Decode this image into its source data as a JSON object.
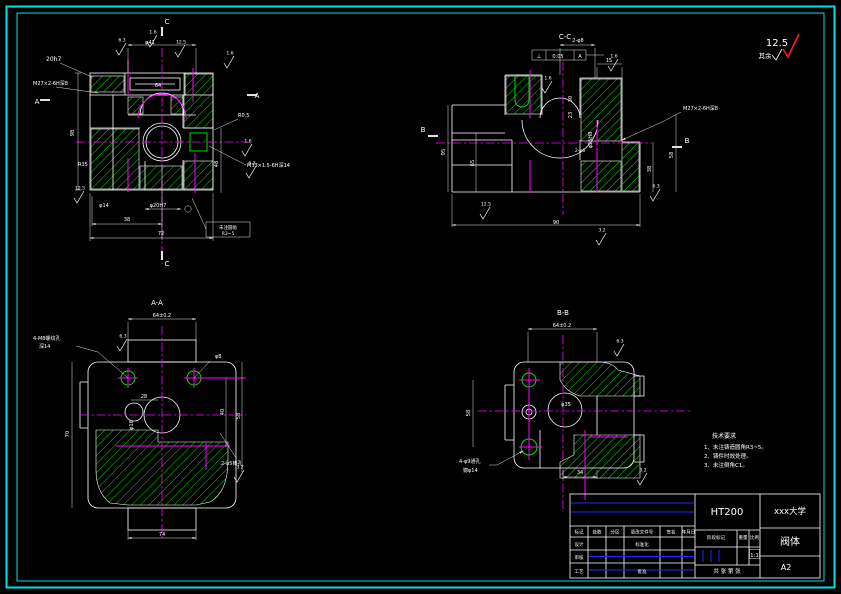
{
  "corner": {
    "roughness": "12.5",
    "rest": "其余"
  },
  "notes": {
    "title": "技术要求",
    "items": [
      "1、未注铸造圆角R3~5。",
      "2、铸件时效处理。",
      "3、未注倒角C1。"
    ],
    "color": "#ff2020"
  },
  "title_block": {
    "material": "HT200",
    "company": "xxx大学",
    "part_name": "阀体",
    "sheet_no": "A2",
    "scale_value": "1:1",
    "header_row": [
      "标记",
      "处数",
      "分区",
      "更改文件号",
      "签名",
      "年月日"
    ],
    "left_rows": {
      "design": "设计",
      "standardize": "标准化",
      "check": "审核",
      "process": "工艺",
      "approve": "批准"
    },
    "mid_labels": {
      "stage": "阶段标记",
      "weight": "重量",
      "scale": "比例"
    },
    "sheet_label": "共 张 第 张"
  },
  "colors": {
    "geometry": "#ffffff",
    "hatch": "#00e400",
    "centerline": "#ff00ff",
    "border": "#00e0e0",
    "table_accent": "#2323ff",
    "notes": "#ff2020"
  },
  "annotations": [
    {
      "t": "20h7",
      "x": 46,
      "y": 61,
      "a": "s",
      "s": 6
    },
    {
      "t": "M27×2-6H深8",
      "x": 33,
      "y": 85,
      "a": "s",
      "s": 5
    },
    {
      "t": "φ41",
      "x": 150,
      "y": 44,
      "s": 5
    },
    {
      "t": "64",
      "x": 158,
      "y": 87,
      "s": 5
    },
    {
      "t": "98",
      "x": 74,
      "y": 133,
      "r": 1,
      "s": 5
    },
    {
      "t": "R35",
      "x": 78,
      "y": 166,
      "a": "s",
      "s": 5
    },
    {
      "t": "φ14",
      "x": 104,
      "y": 207,
      "s": 5
    },
    {
      "t": "φ20H7",
      "x": 158,
      "y": 207,
      "s": 5
    },
    {
      "t": "38",
      "x": 127,
      "y": 221,
      "s": 5
    },
    {
      "t": "72",
      "x": 161,
      "y": 235,
      "s": 5
    },
    {
      "t": "48",
      "x": 218,
      "y": 164,
      "r": 1,
      "s": 5
    },
    {
      "t": "R0.5",
      "x": 238,
      "y": 117,
      "a": "s",
      "s": 5
    },
    {
      "t": "M33×1.5-6H深14",
      "x": 247,
      "y": 167,
      "a": "s",
      "s": 5
    },
    {
      "t": "未注圆角",
      "x": 228,
      "y": 229,
      "s": 4.5
    },
    {
      "t": "R3~5",
      "x": 228,
      "y": 235,
      "s": 4.5
    },
    {
      "t": "C",
      "x": 167,
      "y": 24,
      "s": 7
    },
    {
      "t": "C",
      "x": 167,
      "y": 266,
      "s": 7
    },
    {
      "t": "A",
      "x": 37,
      "y": 104,
      "s": 7
    },
    {
      "t": "A",
      "x": 257,
      "y": 98,
      "s": 7
    },
    {
      "t": "C-C",
      "x": 565,
      "y": 39,
      "s": 7
    },
    {
      "t": "2-φ8",
      "x": 578,
      "y": 42,
      "s": 5
    },
    {
      "t": "15",
      "x": 609,
      "y": 62,
      "s": 5
    },
    {
      "t": "⊥",
      "x": 539,
      "y": 58,
      "s": 6
    },
    {
      "t": "0.05",
      "x": 558,
      "y": 58,
      "s": 5
    },
    {
      "t": "A",
      "x": 580,
      "y": 58,
      "s": 5
    },
    {
      "t": "30",
      "x": 572,
      "y": 99,
      "r": 1,
      "s": 5
    },
    {
      "t": "23",
      "x": 572,
      "y": 115,
      "r": 1,
      "s": 5
    },
    {
      "t": "φ25H8",
      "x": 592,
      "y": 140,
      "r": 1,
      "s": 5
    },
    {
      "t": "2-φ6",
      "x": 580,
      "y": 152,
      "s": 4.5
    },
    {
      "t": "95",
      "x": 445,
      "y": 152,
      "r": 1,
      "s": 5
    },
    {
      "t": "65",
      "x": 474,
      "y": 163,
      "r": 1,
      "s": 5
    },
    {
      "t": "58",
      "x": 673,
      "y": 155,
      "r": 1,
      "s": 5
    },
    {
      "t": "38",
      "x": 651,
      "y": 169,
      "r": 1,
      "s": 5
    },
    {
      "t": "90",
      "x": 556,
      "y": 224,
      "s": 5
    },
    {
      "t": "M27×2-6H深8",
      "x": 683,
      "y": 110,
      "a": "s",
      "s": 5
    },
    {
      "t": "B",
      "x": 423,
      "y": 132,
      "s": 7
    },
    {
      "t": "B",
      "x": 687,
      "y": 143,
      "s": 7
    },
    {
      "t": "A-A",
      "x": 157,
      "y": 305,
      "s": 7
    },
    {
      "t": "64±0.2",
      "x": 162,
      "y": 317,
      "s": 5
    },
    {
      "t": "4-M8螺纹孔",
      "x": 33,
      "y": 340,
      "a": "s",
      "s": 5
    },
    {
      "t": "深14",
      "x": 39,
      "y": 348,
      "a": "s",
      "s": 5
    },
    {
      "t": "φ8",
      "x": 215,
      "y": 358,
      "a": "s",
      "s": 5
    },
    {
      "t": "70",
      "x": 69,
      "y": 434,
      "r": 1,
      "s": 5
    },
    {
      "t": "28",
      "x": 144,
      "y": 398,
      "s": 5
    },
    {
      "t": "φ16",
      "x": 133,
      "y": 425,
      "r": 1,
      "s": 5
    },
    {
      "t": "40",
      "x": 224,
      "y": 412,
      "r": 1,
      "s": 5
    },
    {
      "t": "58",
      "x": 240,
      "y": 416,
      "r": 1,
      "s": 5
    },
    {
      "t": "74",
      "x": 162,
      "y": 536,
      "s": 5
    },
    {
      "t": "2-φ5锥孔",
      "x": 221,
      "y": 465,
      "a": "s",
      "s": 5
    },
    {
      "t": "B-B",
      "x": 563,
      "y": 315,
      "s": 7
    },
    {
      "t": "64±0.2",
      "x": 562,
      "y": 327,
      "s": 5
    },
    {
      "t": "58",
      "x": 470,
      "y": 413,
      "r": 1,
      "s": 5
    },
    {
      "t": "φ35",
      "x": 566,
      "y": 406,
      "s": 5
    },
    {
      "t": "34",
      "x": 580,
      "y": 474,
      "s": 5
    },
    {
      "t": "4-φ9通孔",
      "x": 459,
      "y": 463,
      "a": "s",
      "s": 5
    },
    {
      "t": "锪φ14",
      "x": 463,
      "y": 472,
      "a": "s",
      "s": 5
    }
  ],
  "roughness_marks": [
    {
      "x": 120,
      "y": 50,
      "v": "6.3"
    },
    {
      "x": 151,
      "y": 42,
      "v": "1.6"
    },
    {
      "x": 179,
      "y": 52,
      "v": "12.5"
    },
    {
      "x": 228,
      "y": 63,
      "v": "1.6"
    },
    {
      "x": 246,
      "y": 151,
      "v": "1.6"
    },
    {
      "x": 250,
      "y": 173,
      "v": "6.3"
    },
    {
      "x": 78,
      "y": 198,
      "v": "12.5"
    },
    {
      "x": 612,
      "y": 66,
      "v": "1.6"
    },
    {
      "x": 654,
      "y": 196,
      "v": "6.3"
    },
    {
      "x": 484,
      "y": 214,
      "v": "12.5"
    },
    {
      "x": 600,
      "y": 240,
      "v": "3.2"
    },
    {
      "x": 546,
      "y": 88,
      "v": "1.6"
    },
    {
      "x": 121,
      "y": 346,
      "v": "6.3"
    },
    {
      "x": 238,
      "y": 477,
      "v": "3.2"
    },
    {
      "x": 618,
      "y": 351,
      "v": "6.3"
    },
    {
      "x": 641,
      "y": 480,
      "v": "3.2"
    }
  ]
}
